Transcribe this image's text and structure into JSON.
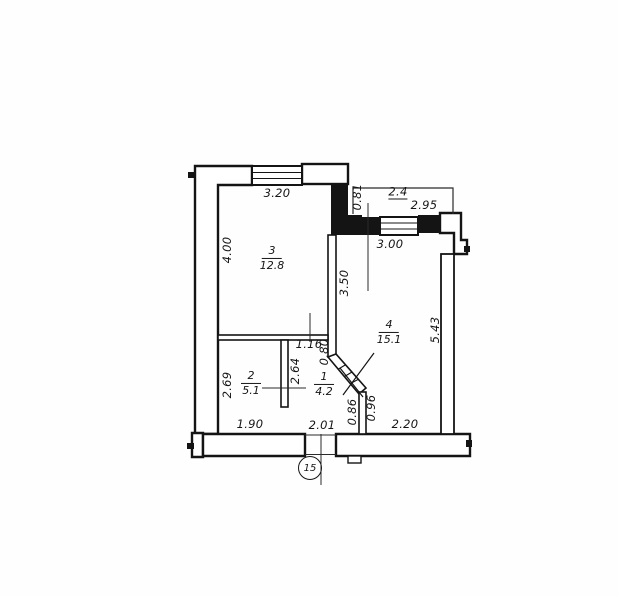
{
  "rooms": [
    {
      "number": "3",
      "area": "12.8"
    },
    {
      "number": "4",
      "area": "15.1"
    },
    {
      "number": "2",
      "area": "5.1"
    },
    {
      "number": "1",
      "area": "4.2"
    }
  ],
  "balcony": {
    "area": "2.4",
    "width": "2.95",
    "offset": "0.81"
  },
  "dimensions": {
    "top_window": "3.20",
    "room3_depth": "4.00",
    "room4_window": "3.00",
    "room4_partition": "3.50",
    "room4_depth": "5.43",
    "hall_opening": "1.16",
    "hall_offset": "0.80",
    "room2_partition": "2.64",
    "room2_depth": "2.69",
    "room2_width": "1.90",
    "hall_width": "2.01",
    "chamfer_left": "0.86",
    "chamfer_right": "0.96",
    "room4_bottom": "2.20"
  },
  "sheet_marker": "15"
}
